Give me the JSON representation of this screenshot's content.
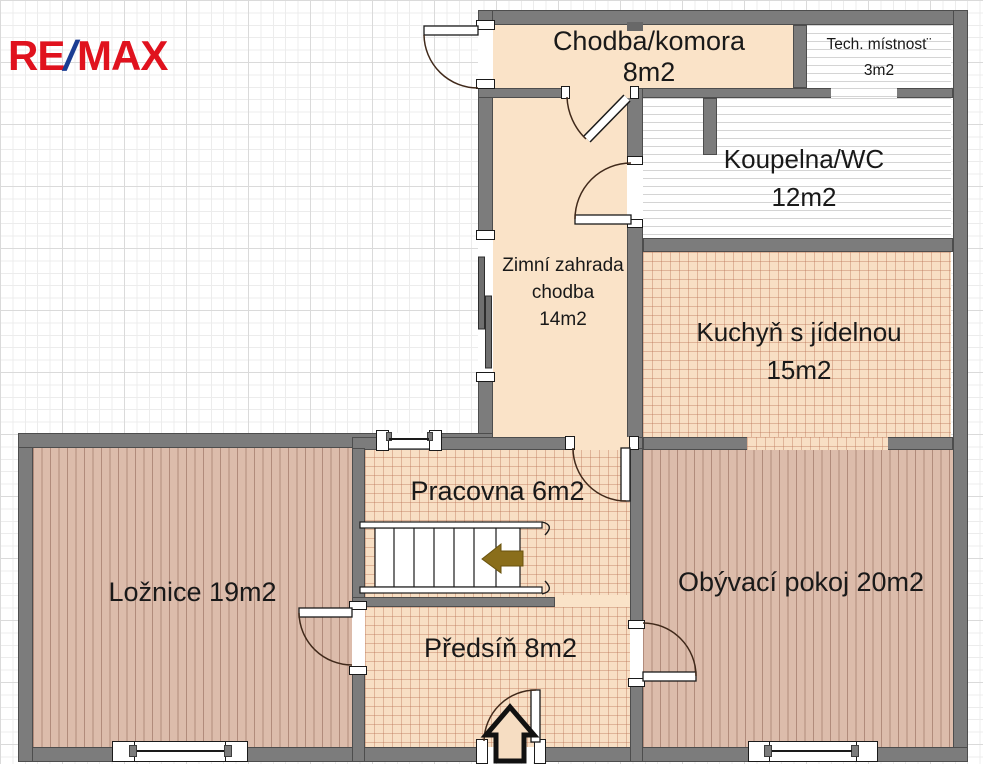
{
  "brand": {
    "logo_re": "RE",
    "logo_slash": "/",
    "logo_max": "MAX"
  },
  "rooms": {
    "chodba": {
      "name": "Chodba/komora",
      "area": "8m2"
    },
    "tech": {
      "name": "Tech. místnost¨",
      "area": "3m2"
    },
    "koupelna": {
      "name": "Koupelna/WC",
      "area": "12m2"
    },
    "zahrada": {
      "name": "Zimní zahrada",
      "name2": "chodba",
      "area": "14m2"
    },
    "kuchyn": {
      "name": "Kuchyň s jídelnou",
      "area": "15m2"
    },
    "loznice": {
      "label": "Ložnice 19m2"
    },
    "pracovna": {
      "label": "Pracovna 6m2"
    },
    "obyvaci": {
      "label": "Obývací pokoj 20m2"
    },
    "predsin": {
      "label": "Předsíň 8m2"
    }
  },
  "colors": {
    "brand_red": "#e0121e",
    "brand_blue": "#1b3d93",
    "wall_gray": "#7c7c7c",
    "wall_outline": "#4d4d4d",
    "room_peach": "#fae3c8",
    "room_tiled_floor": "#f8dfc4",
    "room_wood_floor": "#dcbcab",
    "bathroom_white": "#ffffff",
    "stairs_arrow_olive": "#8a6e1b",
    "entrance_arrow_black": "#111111"
  }
}
